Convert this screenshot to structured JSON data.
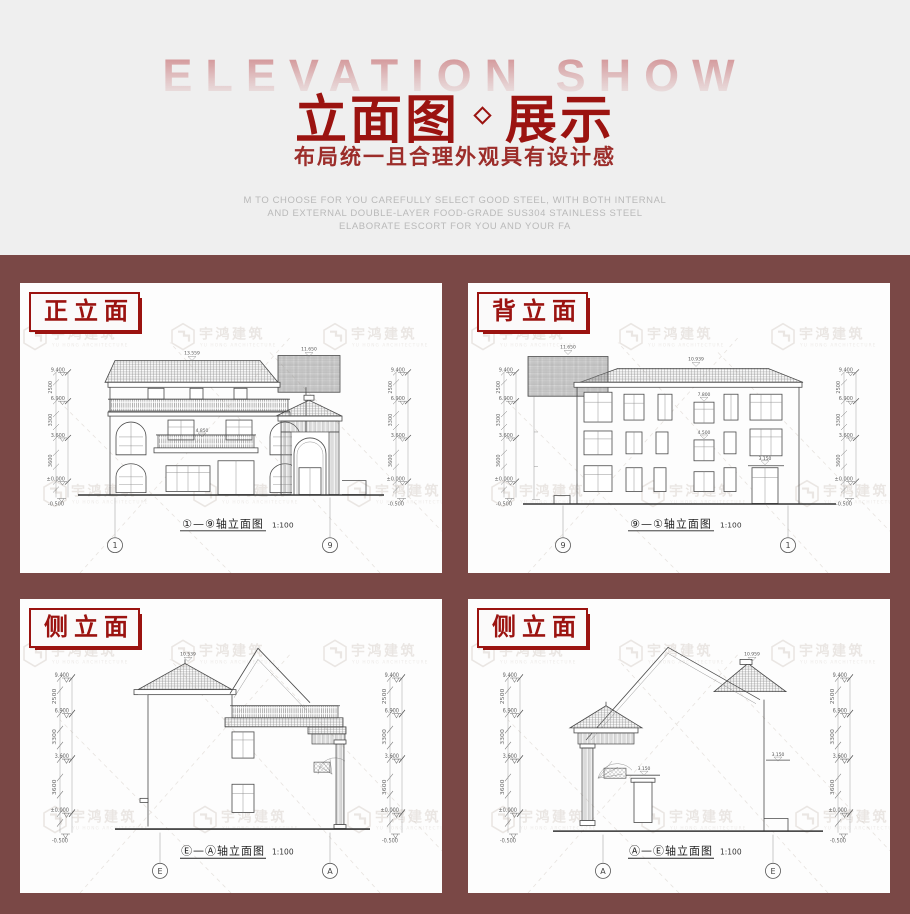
{
  "header": {
    "bg_watermark": "ELEVATION SHOW",
    "title": {
      "left": "立面图",
      "separator": "◇",
      "right": "展示"
    },
    "subtitle": "布局统一且合理外观具有设计感",
    "description_lines": [
      "M TO CHOOSE FOR YOU CAREFULLY SELECT GOOD STEEL, WITH BOTH INTERNAL",
      "AND EXTERNAL DOUBLE-LAYER FOOD-GRADE SUS304 STAINLESS STEEL",
      "ELABORATE ESCORT FOR YOU AND YOUR FA"
    ]
  },
  "colors": {
    "accent_red": "#9b1310",
    "section_maroon": "#7a4846",
    "header_gray": "#efefef",
    "panel_white": "#fdfdfd",
    "watermark_pink": "#d6a0a2",
    "watermark_gray": "#d8d1cb"
  },
  "watermark": {
    "cn": "宇鸿建筑",
    "en": "YU HONG ARCHITECTURE"
  },
  "drawing": {
    "scale": "1:100",
    "elevation_marks": {
      "rf": "9.400",
      "f3": "6.900",
      "f2": "3.600",
      "f1": "±0.000",
      "base": "-0.500"
    },
    "segment_dims": {
      "top": "2500",
      "mid": "3300",
      "bot": "3600"
    },
    "labels": {
      "front_ridge": "13.559",
      "front_tower": "11.650",
      "balcony": "4.850",
      "back_ridge": "10.939",
      "back_tower": "11.650",
      "back_win_upper": "7.800",
      "back_win_lower": "4.500",
      "canopy": "3.150",
      "side_ea_ridge": "10.539",
      "side_ae_ridge": "10.959"
    }
  },
  "panels": [
    {
      "label": "正立面",
      "caption": "①—⑨轴立面图",
      "scale": "1:100",
      "axis_left": "1",
      "axis_right": "9"
    },
    {
      "label": "背立面",
      "caption": "⑨—①轴立面图",
      "scale": "1:100",
      "axis_left": "9",
      "axis_right": "1"
    },
    {
      "label": "侧立面",
      "caption": "Ⓔ—Ⓐ轴立面图",
      "scale": "1:100",
      "axis_left": "E",
      "axis_right": "A"
    },
    {
      "label": "侧立面",
      "caption": "Ⓐ—Ⓔ轴立面图",
      "scale": "1:100",
      "axis_left": "A",
      "axis_right": "E"
    }
  ]
}
